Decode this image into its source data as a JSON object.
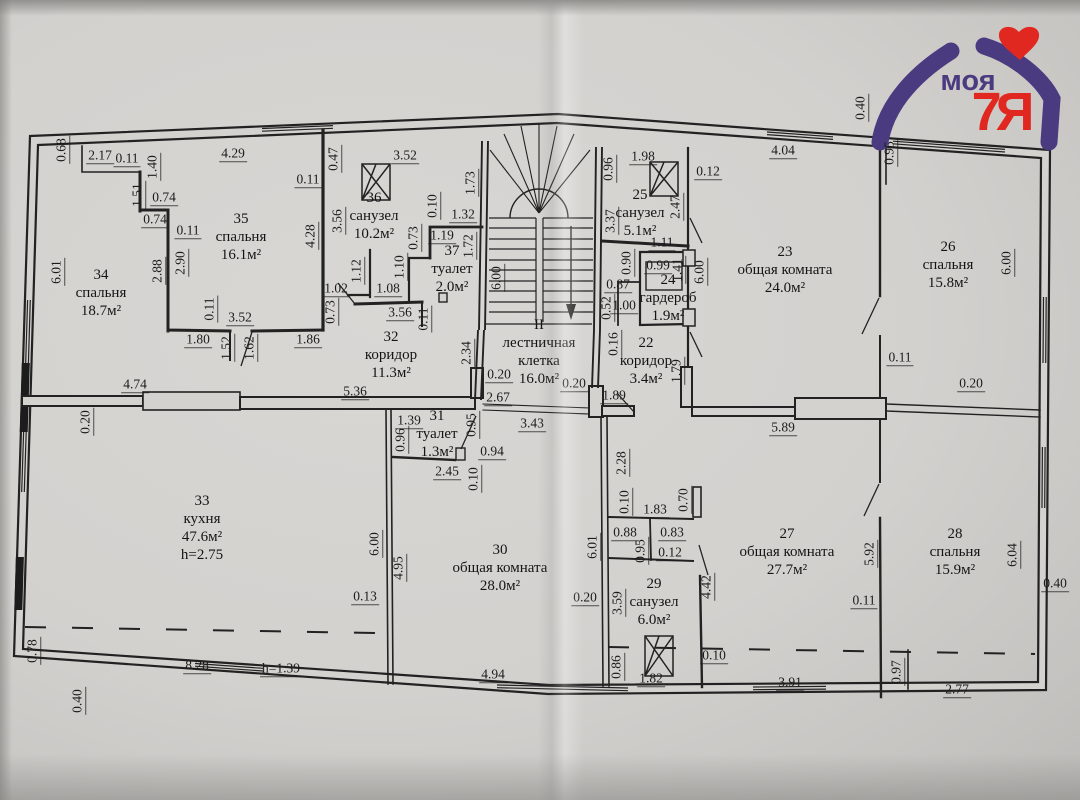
{
  "document": {
    "type": "apartment floor plan scan",
    "floor_mark": "II",
    "attic_height_note": "h=1.39",
    "ink_color": "#222222",
    "paper_color": "#d4d2cf"
  },
  "logo": {
    "word": "моя",
    "suffix": "7Я",
    "purple": "#4a3b80",
    "red": "#e02820"
  },
  "rooms": [
    {
      "id": "34",
      "number": "34",
      "name": "спальня",
      "area": "18.7м²",
      "x": 101,
      "y": 293
    },
    {
      "id": "35",
      "number": "35",
      "name": "спальня",
      "area": "16.1м²",
      "x": 241,
      "y": 237
    },
    {
      "id": "36",
      "number": "36",
      "name": "санузел",
      "area": "10.2м²",
      "x": 374,
      "y": 216
    },
    {
      "id": "37",
      "number": "37",
      "name": "туалет",
      "area": "2.0м²",
      "x": 452,
      "y": 269,
      "w": 70
    },
    {
      "id": "32",
      "number": "32",
      "name": "коридор",
      "area": "11.3м²",
      "x": 391,
      "y": 355
    },
    {
      "id": "stairwell",
      "number": "II",
      "name": "лестничная клетка",
      "area": "16.0м²",
      "x": 539,
      "y": 352,
      "w": 106
    },
    {
      "id": "25",
      "number": "25",
      "name": "санузел",
      "area": "5.1м²",
      "x": 640,
      "y": 213
    },
    {
      "id": "24",
      "number": "24",
      "name": "гардероб",
      "area": "1.9м²",
      "x": 668,
      "y": 298,
      "w": 110
    },
    {
      "id": "22",
      "number": "22",
      "name": "коридор",
      "area": "3.4м²",
      "x": 646,
      "y": 361,
      "w": 110
    },
    {
      "id": "23",
      "number": "23",
      "name": "общая комната",
      "area": "24.0м²",
      "x": 785,
      "y": 270,
      "w": 100
    },
    {
      "id": "26",
      "number": "26",
      "name": "спальня",
      "area": "15.8м²",
      "x": 948,
      "y": 265
    },
    {
      "id": "33",
      "number": "33",
      "name": "кухня",
      "area": "47.6м²",
      "extra": "h=2.75",
      "x": 202,
      "y": 528
    },
    {
      "id": "31",
      "number": "31",
      "name": "туалет",
      "area": "1.3м²",
      "x": 437,
      "y": 434,
      "w": 110
    },
    {
      "id": "30",
      "number": "30",
      "name": "общая комната",
      "area": "28.0м²",
      "x": 500,
      "y": 568,
      "w": 100
    },
    {
      "id": "29",
      "number": "29",
      "name": "санузел",
      "area": "6.0м²",
      "x": 654,
      "y": 602
    },
    {
      "id": "27",
      "number": "27",
      "name": "общая комната",
      "area": "27.7м²",
      "x": 787,
      "y": 552,
      "w": 100
    },
    {
      "id": "28",
      "number": "28",
      "name": "спальня",
      "area": "15.9м²",
      "x": 955,
      "y": 552
    }
  ],
  "dimensions": [
    {
      "t": "0.68",
      "x": 62,
      "y": 150,
      "r": 1
    },
    {
      "t": "2.17",
      "x": 100,
      "y": 156
    },
    {
      "t": "0.11",
      "x": 127,
      "y": 159
    },
    {
      "t": "1.40",
      "x": 153,
      "y": 167,
      "r": 1
    },
    {
      "t": "4.29",
      "x": 233,
      "y": 154
    },
    {
      "t": "1.51",
      "x": 138,
      "y": 195,
      "r": 1
    },
    {
      "t": "0.74",
      "x": 164,
      "y": 198
    },
    {
      "t": "0.74",
      "x": 155,
      "y": 220
    },
    {
      "t": "0.11",
      "x": 188,
      "y": 231
    },
    {
      "t": "2.88",
      "x": 158,
      "y": 271,
      "r": 1
    },
    {
      "t": "2.90",
      "x": 181,
      "y": 263,
      "r": 1
    },
    {
      "t": "6.01",
      "x": 57,
      "y": 272,
      "r": 1
    },
    {
      "t": "0.11",
      "x": 308,
      "y": 180
    },
    {
      "t": "4.28",
      "x": 311,
      "y": 236,
      "r": 1
    },
    {
      "t": "3.56",
      "x": 338,
      "y": 221,
      "r": 1
    },
    {
      "t": "0.47",
      "x": 334,
      "y": 159,
      "r": 1
    },
    {
      "t": "3.52",
      "x": 405,
      "y": 156
    },
    {
      "t": "0.11",
      "x": 210,
      "y": 309,
      "r": 1
    },
    {
      "t": "3.52",
      "x": 240,
      "y": 318
    },
    {
      "t": "1.80",
      "x": 198,
      "y": 340
    },
    {
      "t": "1.52",
      "x": 227,
      "y": 348,
      "r": 1
    },
    {
      "t": "1.62",
      "x": 250,
      "y": 348,
      "r": 1
    },
    {
      "t": "1.86",
      "x": 308,
      "y": 340
    },
    {
      "t": "0.73",
      "x": 331,
      "y": 312,
      "r": 1
    },
    {
      "t": "3.56",
      "x": 400,
      "y": 313
    },
    {
      "t": "0.11",
      "x": 424,
      "y": 319,
      "r": 1
    },
    {
      "t": "1.02",
      "x": 336,
      "y": 289
    },
    {
      "t": "1.08",
      "x": 388,
      "y": 289
    },
    {
      "t": "1.12",
      "x": 357,
      "y": 271,
      "r": 1
    },
    {
      "t": "1.10",
      "x": 400,
      "y": 267,
      "r": 1
    },
    {
      "t": "0.73",
      "x": 414,
      "y": 238,
      "r": 1
    },
    {
      "t": "1.19",
      "x": 442,
      "y": 236
    },
    {
      "t": "1.32",
      "x": 463,
      "y": 215
    },
    {
      "t": "0.10",
      "x": 433,
      "y": 206,
      "r": 1
    },
    {
      "t": "1.73",
      "x": 471,
      "y": 183,
      "r": 1
    },
    {
      "t": "1.72",
      "x": 469,
      "y": 246,
      "r": 1
    },
    {
      "t": "6.00",
      "x": 497,
      "y": 278,
      "r": 1
    },
    {
      "t": "2.34",
      "x": 467,
      "y": 353,
      "r": 1
    },
    {
      "t": "0.20",
      "x": 499,
      "y": 375
    },
    {
      "t": "2.67",
      "x": 498,
      "y": 398
    },
    {
      "t": "5.36",
      "x": 355,
      "y": 392
    },
    {
      "t": "0.20",
      "x": 574,
      "y": 384
    },
    {
      "t": "1.89",
      "x": 614,
      "y": 396
    },
    {
      "t": "3.43",
      "x": 532,
      "y": 424
    },
    {
      "t": "1.98",
      "x": 643,
      "y": 157
    },
    {
      "t": "0.96",
      "x": 609,
      "y": 169,
      "r": 1
    },
    {
      "t": "0.12",
      "x": 708,
      "y": 172
    },
    {
      "t": "2.47",
      "x": 676,
      "y": 207,
      "r": 1
    },
    {
      "t": "3.37",
      "x": 611,
      "y": 221,
      "r": 1
    },
    {
      "t": "1.11",
      "x": 662,
      "y": 243
    },
    {
      "t": "0.90",
      "x": 627,
      "y": 263,
      "r": 1
    },
    {
      "t": "0.99",
      "x": 658,
      "y": 266
    },
    {
      "t": "1.41",
      "x": 678,
      "y": 270,
      "r": 1
    },
    {
      "t": "0.87",
      "x": 618,
      "y": 285
    },
    {
      "t": "6.00",
      "x": 700,
      "y": 272,
      "r": 1
    },
    {
      "t": "0.52",
      "x": 607,
      "y": 308,
      "r": 1
    },
    {
      "t": "1.00",
      "x": 624,
      "y": 306
    },
    {
      "t": "0.16",
      "x": 614,
      "y": 344,
      "r": 1
    },
    {
      "t": "1.79",
      "x": 677,
      "y": 371,
      "r": 1
    },
    {
      "t": "4.04",
      "x": 783,
      "y": 151
    },
    {
      "t": "0.40",
      "x": 861,
      "y": 108,
      "r": 1
    },
    {
      "t": "0.95",
      "x": 890,
      "y": 153,
      "r": 1
    },
    {
      "t": "0.11",
      "x": 900,
      "y": 358
    },
    {
      "t": "0.20",
      "x": 971,
      "y": 384
    },
    {
      "t": "6.00",
      "x": 1007,
      "y": 263,
      "r": 1
    },
    {
      "t": "5.89",
      "x": 783,
      "y": 428
    },
    {
      "t": "0.20",
      "x": 86,
      "y": 422,
      "r": 1
    },
    {
      "t": "4.74",
      "x": 135,
      "y": 385
    },
    {
      "t": "6.00",
      "x": 375,
      "y": 544,
      "r": 1
    },
    {
      "t": "0.13",
      "x": 365,
      "y": 597
    },
    {
      "t": "0.78",
      "x": 33,
      "y": 651,
      "r": 1
    },
    {
      "t": "8.28",
      "x": 197,
      "y": 666
    },
    {
      "t": "h=1.39",
      "x": 281,
      "y": 669
    },
    {
      "t": "0.40",
      "x": 78,
      "y": 701,
      "r": 1
    },
    {
      "t": "4.94",
      "x": 493,
      "y": 675
    },
    {
      "t": "1.39",
      "x": 409,
      "y": 421
    },
    {
      "t": "0.96",
      "x": 401,
      "y": 440,
      "r": 1
    },
    {
      "t": "0.95",
      "x": 472,
      "y": 425,
      "r": 1
    },
    {
      "t": "0.94",
      "x": 492,
      "y": 452
    },
    {
      "t": "2.45",
      "x": 447,
      "y": 472
    },
    {
      "t": "0.10",
      "x": 474,
      "y": 479,
      "r": 1
    },
    {
      "t": "4.95",
      "x": 399,
      "y": 568,
      "r": 1
    },
    {
      "t": "2.28",
      "x": 622,
      "y": 463,
      "r": 1
    },
    {
      "t": "0.10",
      "x": 625,
      "y": 502,
      "r": 1
    },
    {
      "t": "6.01",
      "x": 593,
      "y": 547,
      "r": 1
    },
    {
      "t": "0.20",
      "x": 585,
      "y": 598
    },
    {
      "t": "1.83",
      "x": 655,
      "y": 510
    },
    {
      "t": "0.70",
      "x": 684,
      "y": 500,
      "r": 1
    },
    {
      "t": "0.88",
      "x": 625,
      "y": 533
    },
    {
      "t": "0.83",
      "x": 672,
      "y": 533
    },
    {
      "t": "0.95",
      "x": 641,
      "y": 551,
      "r": 1
    },
    {
      "t": "0.12",
      "x": 670,
      "y": 553
    },
    {
      "t": "3.59",
      "x": 618,
      "y": 603,
      "r": 1
    },
    {
      "t": "4.42",
      "x": 707,
      "y": 587,
      "r": 1
    },
    {
      "t": "0.86",
      "x": 617,
      "y": 667,
      "r": 1
    },
    {
      "t": "1.82",
      "x": 651,
      "y": 679
    },
    {
      "t": "0.10",
      "x": 714,
      "y": 656
    },
    {
      "t": "3.91",
      "x": 790,
      "y": 683
    },
    {
      "t": "0.97",
      "x": 897,
      "y": 672,
      "r": 1
    },
    {
      "t": "2.77",
      "x": 957,
      "y": 690
    },
    {
      "t": "0.11",
      "x": 864,
      "y": 601
    },
    {
      "t": "5.92",
      "x": 870,
      "y": 554,
      "r": 1
    },
    {
      "t": "6.04",
      "x": 1013,
      "y": 555,
      "r": 1
    },
    {
      "t": "0.40",
      "x": 1055,
      "y": 584
    }
  ]
}
